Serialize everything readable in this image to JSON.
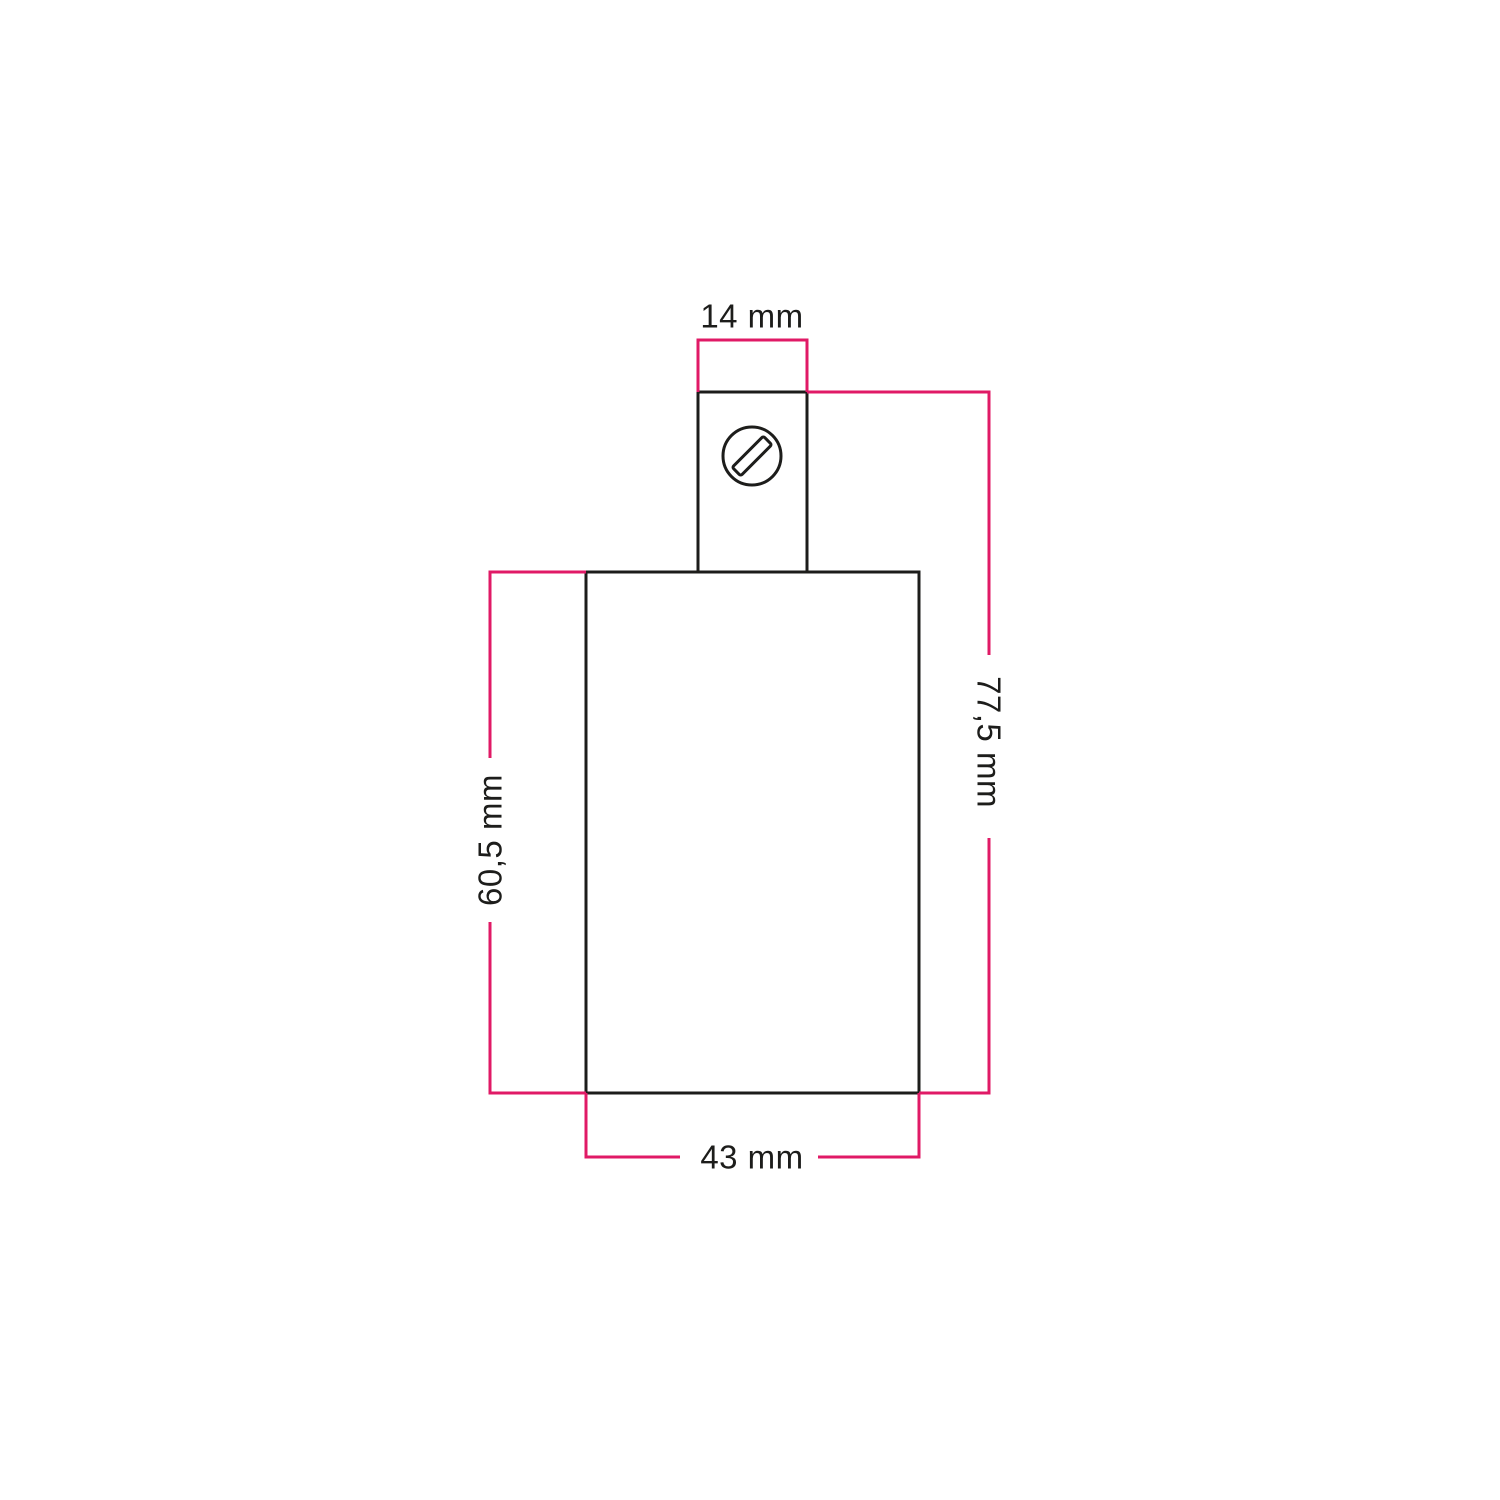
{
  "colors": {
    "accent": "#e01a66",
    "ink": "#1d1d1b",
    "background": "#ffffff"
  },
  "drawing": {
    "kind": "technical-dimension-drawing",
    "labels": {
      "top_width": "14 mm",
      "overall_height": "77,5 mm",
      "body_height": "60,5 mm",
      "body_width": "43 mm"
    },
    "icons": {
      "screw": "slotted-screw-head-icon"
    }
  }
}
